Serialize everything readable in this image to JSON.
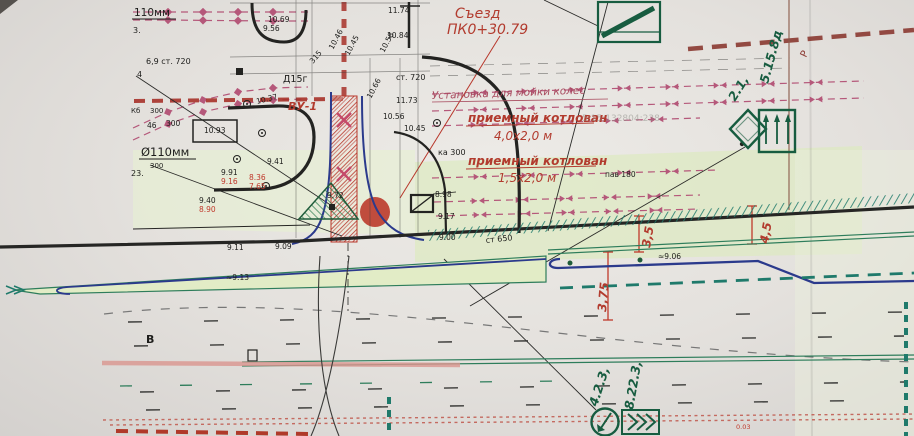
{
  "callouts": {
    "exit_line1": "Съезд",
    "exit_line2": "ПК0+30.79",
    "wheel_wash": "Установка для мойки колес",
    "pit1_name": "приемный котлован",
    "pit1_size": "4,0х2,0 м",
    "pit2_name": "приемный котлован",
    "pit2_size": "1,5х2,0 м",
    "cadastral": "5:15:132804:238"
  },
  "pipes": {
    "top": "110мм",
    "mid": "Ø110мм"
  },
  "stations": {
    "st720a": "6,9   ст. 720",
    "st720b": "ст. 720",
    "st650": "ст 650",
    "pav180": "пав 180",
    "ka300": "ка  300"
  },
  "refs": {
    "vu": "ВУ-1",
    "d15": "Д15г",
    "n3": "3.",
    "n4": "4",
    "n23": "23.",
    "n46": "46",
    "n300a": "300",
    "n300b": "300",
    "n300c": "300",
    "n315": "315",
    "kb": "Кб",
    "letter_b": "В",
    "letter_p": "Р",
    "mark": "0.03"
  },
  "elevations": {
    "e1174": "11.74",
    "e1084": "10.84",
    "e1069": "10.69",
    "e956": "9.56",
    "e1046": "10.46",
    "e1045": "10.45",
    "e1058": "10.58",
    "e1066": "10.66",
    "e1173": "11.73",
    "e1056": "10.56",
    "e1045b": "10.45",
    "e1093": "10.93",
    "e1037": "10.37",
    "e991": "9.91",
    "e941": "9.41",
    "e940": "9.40",
    "e972": "9.72",
    "e917": "9.17",
    "e898": "8.98",
    "e900": "9.00",
    "e906": "≈9.06",
    "e911": "9.11",
    "e909": "9.09",
    "e913": "≈9.13"
  },
  "elevations_red": {
    "e916": "9.16",
    "e836": "8.36",
    "e765": "7.65",
    "e890": "8.90"
  },
  "dimensions": {
    "w35": "3,5",
    "w375": "3,75",
    "w45": "4,5"
  },
  "traffic_signs": {
    "priority_road": "2.1,",
    "lanes": "5.15.8д",
    "direction": "4.2.3,",
    "plate": "8.22.3,"
  },
  "colors": {
    "red_ink": "#b23b2e",
    "green_ink": "#175c40",
    "pink_utility": "#b5587a",
    "blue_ink": "#2b3a8c",
    "teal_ink": "#1f7a6b"
  }
}
